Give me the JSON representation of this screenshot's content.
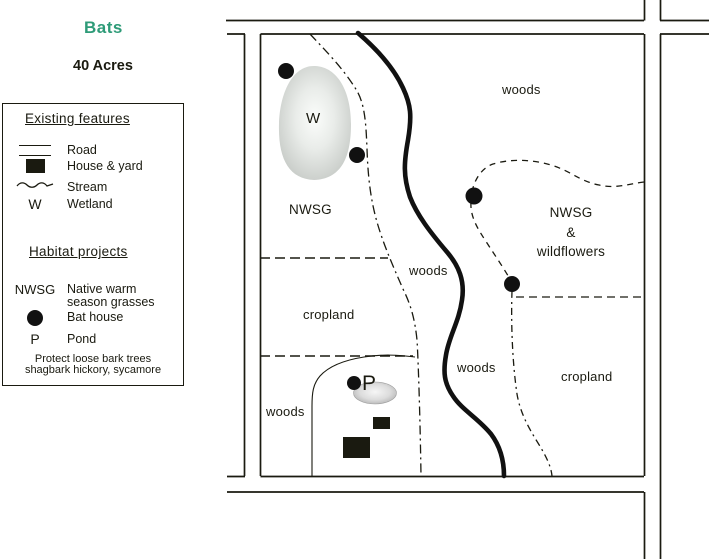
{
  "title": "Bats",
  "subtitle": "40 Acres",
  "colors": {
    "title_green": "#2E9B78",
    "ink": "#1A1A10",
    "wetland_edge": "#C6CAC6",
    "pond_edge": "#ABABAB"
  },
  "legend": {
    "existing_heading": "Existing features",
    "existing": [
      {
        "symbol": "road-symbol",
        "label": "Road"
      },
      {
        "symbol": "house-symbol",
        "label": "House & yard"
      },
      {
        "symbol": "stream-symbol",
        "label": "Stream"
      },
      {
        "symbol_text": "W",
        "label": "Wetland"
      }
    ],
    "habitat_heading": "Habitat projects",
    "habitat": [
      {
        "symbol_text": "NWSG",
        "label": "Native warm season grasses"
      },
      {
        "symbol": "bat-house-symbol",
        "label": "Bat house"
      },
      {
        "symbol_text": "P",
        "label": "Pond"
      }
    ],
    "note_line1": "Protect loose bark trees",
    "note_line2": "shagbark hickory, sycamore"
  },
  "map": {
    "wetland_letter": "W",
    "pond_letter": "P",
    "labels": {
      "woods_northeast": "woods",
      "nwsg_west": "NWSG",
      "woods_center": "woods",
      "nwsg_wildflowers_line1": "NWSG",
      "nwsg_wildflowers_line2": "&",
      "nwsg_wildflowers_line3": "wildflowers",
      "cropland_west": "cropland",
      "woods_south": "woods",
      "cropland_southeast": "cropland",
      "woods_southwest": "woods"
    }
  }
}
